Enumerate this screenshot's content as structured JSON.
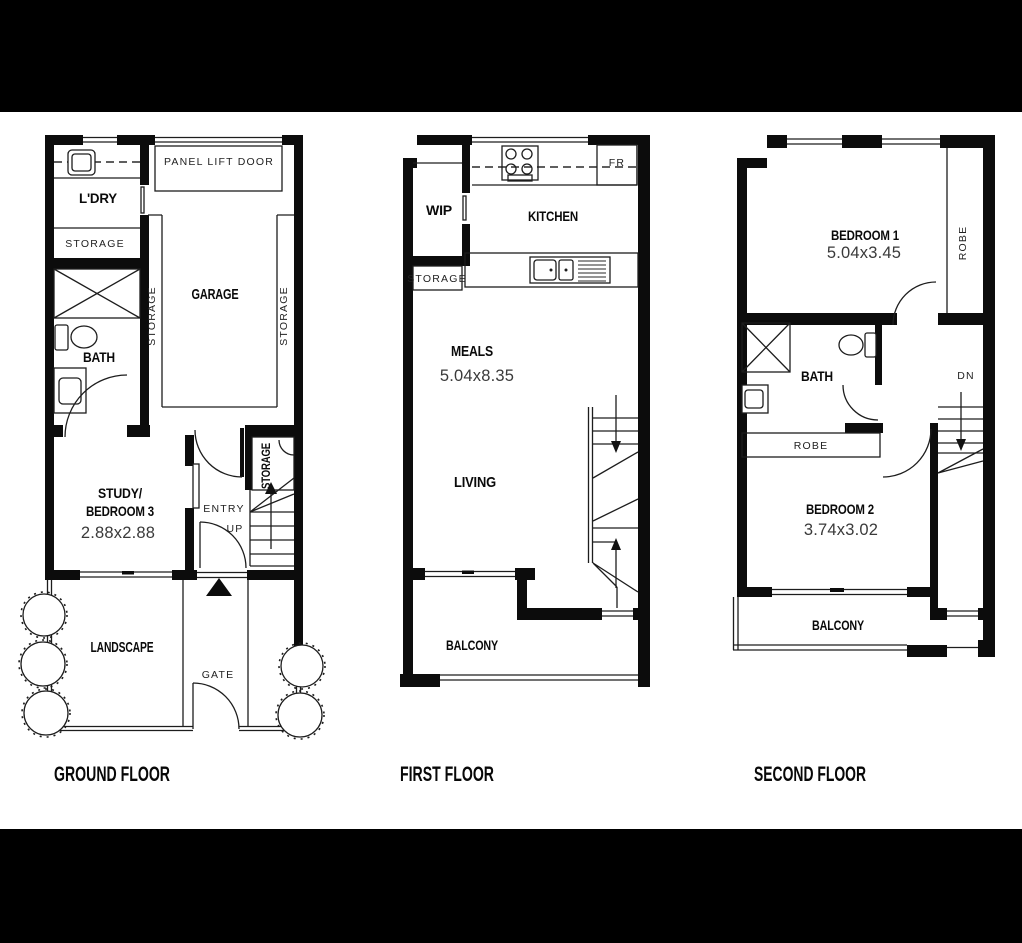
{
  "page": {
    "background": "#000000",
    "paper": "#ffffff",
    "wall_color": "#0c0c0c"
  },
  "floors": [
    {
      "title": "GROUND FLOOR",
      "labels": {
        "ldry": "L'DRY",
        "storage_room": "STORAGE",
        "bath": "BATH",
        "garage": "GARAGE",
        "panel_lift_door": "PANEL LIFT DOOR",
        "storage_garage_left": "STORAGE",
        "storage_garage_right": "STORAGE",
        "study1": "STUDY/",
        "study2": "BEDROOM 3",
        "study_dim": "2.88x2.88",
        "entry": "ENTRY",
        "up": "UP",
        "storage_under_stairs": "STORAGE",
        "landscape": "LANDSCAPE",
        "gate": "GATE"
      }
    },
    {
      "title": "FIRST FLOOR",
      "labels": {
        "wip": "WIP",
        "kitchen": "KITCHEN",
        "fridge": "FR",
        "storage": "STORAGE",
        "meals": "MEALS",
        "meals_dim": "5.04x8.35",
        "living": "LIVING",
        "balcony": "BALCONY"
      }
    },
    {
      "title": "SECOND FLOOR",
      "labels": {
        "bedroom1": "BEDROOM 1",
        "bedroom1_dim": "5.04x3.45",
        "robe_bedroom1": "ROBE",
        "bath": "BATH",
        "dn": "DN",
        "robe_hall": "ROBE",
        "bedroom2": "BEDROOM 2",
        "bedroom2_dim": "3.74x3.02",
        "balcony": "BALCONY"
      }
    }
  ]
}
